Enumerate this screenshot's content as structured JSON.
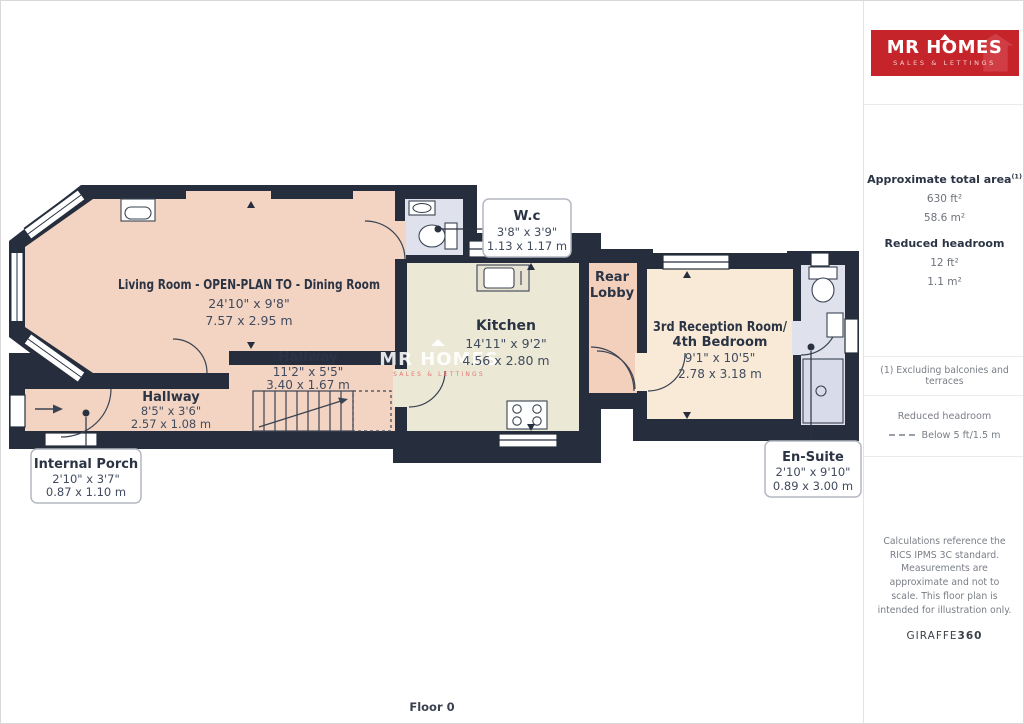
{
  "floor_label": "Floor 0",
  "rooms": {
    "living": {
      "name": "Living Room - OPEN-PLAN TO - Dining Room",
      "imperial": "24'10\" x 9'8\"",
      "metric": "7.57 x 2.95 m"
    },
    "hallway_main": {
      "name": "Hallway",
      "imperial": "11'2\" x 5'5\"",
      "metric": "3.40 x 1.67 m"
    },
    "hallway_front": {
      "name": "Hallway",
      "imperial": "8'5\" x 3'6\"",
      "metric": "2.57 x 1.08 m"
    },
    "kitchen": {
      "name": "Kitchen",
      "imperial": "14'11\" x 9'2\"",
      "metric": "4.56 x 2.80 m"
    },
    "rear_lobby": {
      "name_line1": "Rear",
      "name_line2": "Lobby"
    },
    "reception": {
      "name_line1": "3rd Reception Room/",
      "name_line2": "4th Bedroom",
      "imperial": "9'1\" x 10'5\"",
      "metric": "2.78 x 3.18 m"
    },
    "wc": {
      "name": "W.c",
      "imperial": "3'8\" x 3'9\"",
      "metric": "1.13 x 1.17 m"
    },
    "internal_porch": {
      "name": "Internal Porch",
      "imperial": "2'10\" x 3'7\"",
      "metric": "0.87 x 1.10 m"
    },
    "ensuite": {
      "name": "En-Suite",
      "imperial": "2'10\" x 9'10\"",
      "metric": "0.89 x 3.00 m"
    }
  },
  "watermark": {
    "brand": "MR HOMES",
    "tagline": "SALES & LETTINGS"
  },
  "sidebar": {
    "logo": {
      "brand": "MR HOMES",
      "tagline": "SALES & LETTINGS"
    },
    "total_area": {
      "label": "Approximate total area",
      "superscript": "(1)",
      "imperial": "630 ft²",
      "metric": "58.6 m²"
    },
    "reduced_headroom": {
      "label": "Reduced headroom",
      "imperial": "12 ft²",
      "metric": "1.1 m²"
    },
    "footnote": "(1) Excluding balconies and terraces",
    "legend": {
      "label": "Reduced headroom",
      "value": "Below 5 ft/1.5 m"
    },
    "disclaimer": "Calculations reference the RICS IPMS 3C standard. Measurements are approximate and not to scale. This floor plan is intended for illustration only.",
    "provider": {
      "name": "GIRAFFE",
      "suffix": "360"
    }
  },
  "colors": {
    "wall": "#262e3d",
    "room_peach": "#f3d4c2",
    "room_lobby": "#f2d0bc",
    "room_cream": "#ebe8d6",
    "room_light_cream": "#f8ead6",
    "room_blue": "#dfe2ed",
    "brand_red": "#c5242b"
  }
}
